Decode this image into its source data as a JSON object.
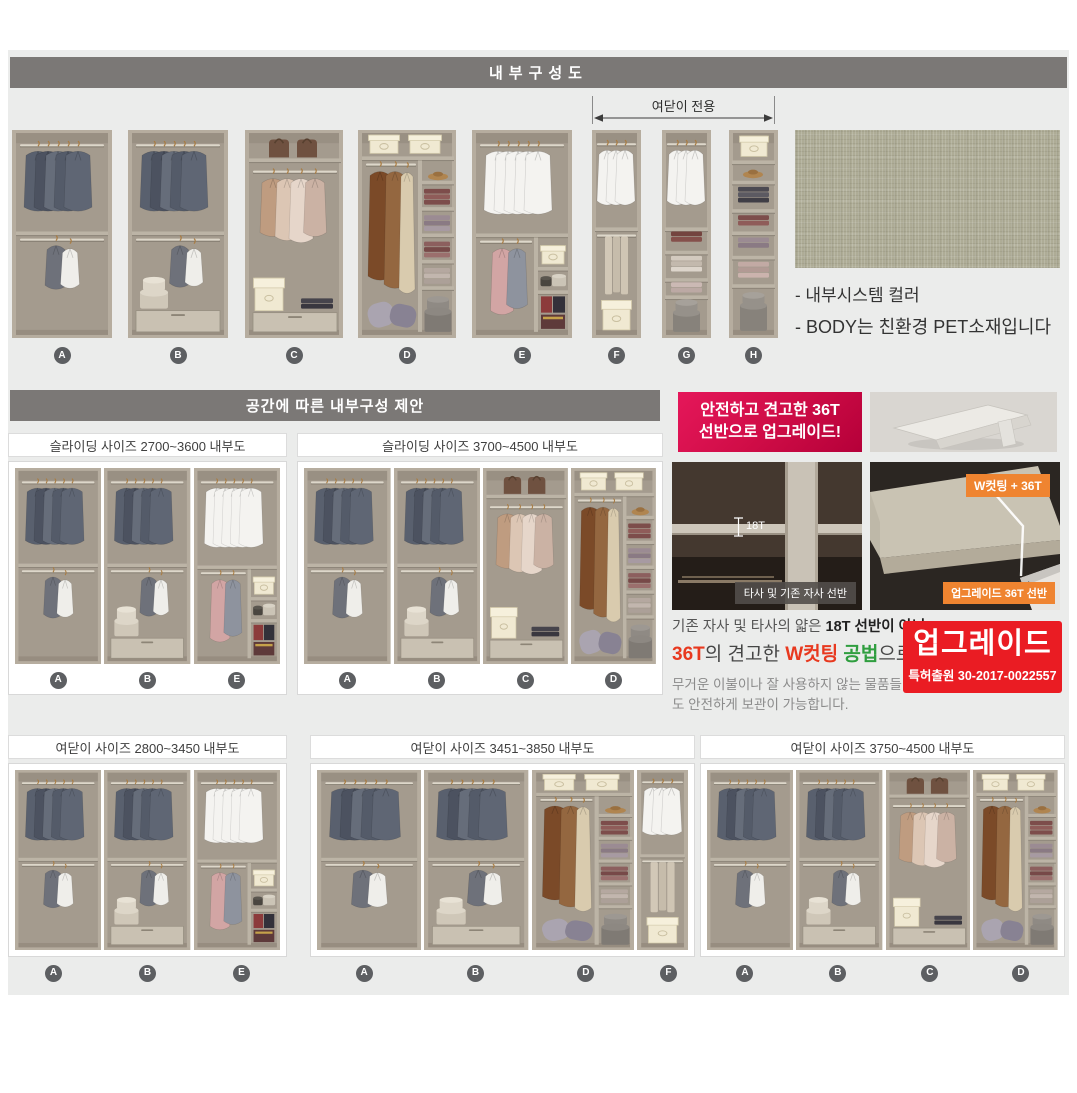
{
  "header1": {
    "title": "내부구성도"
  },
  "top_row": {
    "annotation": "여닫이 전용",
    "units": [
      "A",
      "B",
      "C",
      "D",
      "E",
      "F",
      "G",
      "H"
    ]
  },
  "swatch_notes": [
    "- 내부시스템 컬러",
    "- BODY는 친환경 PET소재입니다"
  ],
  "header2": {
    "title": "공간에 따른 내부구성 제안"
  },
  "proposals_top": [
    {
      "title": "슬라이딩 사이즈 2700~3600 내부도",
      "units": [
        "A",
        "B",
        "E"
      ]
    },
    {
      "title": "슬라이딩 사이즈 3700~4500 내부도",
      "units": [
        "A",
        "B",
        "C",
        "D"
      ]
    }
  ],
  "proposals_bottom": [
    {
      "title": "여닫이 사이즈 2800~3450 내부도",
      "units": [
        "A",
        "B",
        "E"
      ]
    },
    {
      "title": "여닫이 사이즈 3451~3850 내부도",
      "units": [
        "A",
        "B",
        "D",
        "F"
      ]
    },
    {
      "title": "여닫이 사이즈 3750~4500 내부도",
      "units": [
        "A",
        "B",
        "C",
        "D"
      ]
    }
  ],
  "upgrade": {
    "banner": {
      "line1": "안전하고 견고한 36T",
      "line2": "선반으로 업그레이드!"
    },
    "photo_old": {
      "measure": "18T",
      "caption": "타사 및 기존 자사 선반"
    },
    "photo_new": {
      "badge": "W컷팅 + 36T",
      "caption": "업그레이드 36T 선반"
    },
    "desc_line1": [
      {
        "t": "기존 자사 및 타사의 얇은 ",
        "s": "n"
      },
      {
        "t": "18T 선반이 아닌",
        "s": "b"
      }
    ],
    "desc_line2": [
      {
        "t": "36T",
        "s": "red"
      },
      {
        "t": "의 견고한 ",
        "s": "n2"
      },
      {
        "t": "W컷팅",
        "s": "red"
      },
      {
        "t": " ",
        "s": "n2"
      },
      {
        "t": "공법",
        "s": "green"
      },
      {
        "t": "으로",
        "s": "n2"
      }
    ],
    "note": "무거운 이불이나 잘 사용하지 않는 물품들도 안전하게 보관이 가능합니다.",
    "patent": {
      "title": "업그레이드",
      "number": "특허출원 30-2017-0022557"
    }
  },
  "colors": {
    "header_gray": "#7b7876",
    "panel_bg": "#ebeceb",
    "banner_red": "#d00d47",
    "patent_red": "#ea1c23",
    "badge_orange": "#ef8430",
    "swatch_green": "#aeac96"
  }
}
